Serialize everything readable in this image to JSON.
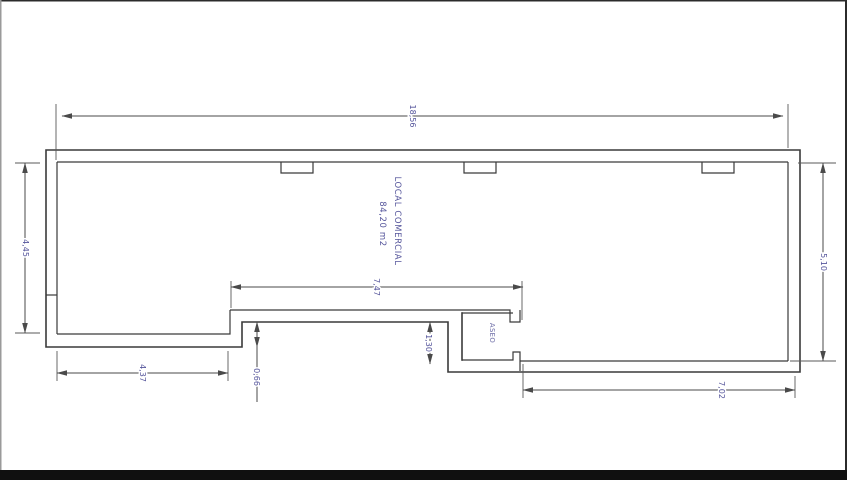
{
  "drawing": {
    "title": "LOCAL COMERCIAL",
    "area": "84,20 m2",
    "rooms": {
      "aseo": "ASEO"
    },
    "dimensions": {
      "total_width": "18,56",
      "left_depth": "4,45",
      "right_depth": "5,10",
      "recess_width": "7,47",
      "bottom_left_width": "4,37",
      "step": "0,66",
      "recess_depth": "1,30",
      "bottom_right_width": "7,02"
    },
    "colors": {
      "wall_line": "#3a3a3a",
      "dimension_line": "#4a4a4a",
      "annotation_text": "#55559b",
      "frame_bar": "#101010",
      "background": "#ffffff"
    }
  }
}
